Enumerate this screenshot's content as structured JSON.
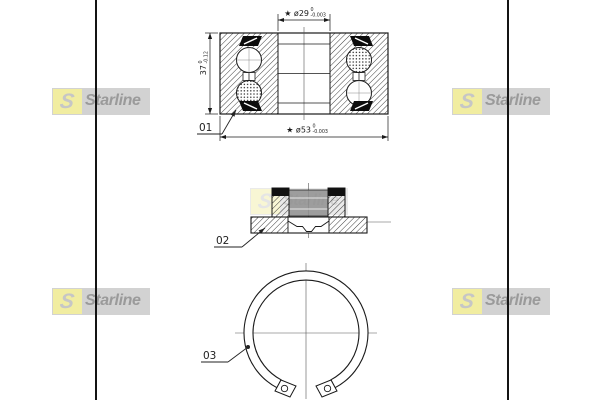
{
  "brand": {
    "name": "Starline",
    "logo_initial": "S"
  },
  "callouts": {
    "part1": "01",
    "part2": "02",
    "part3": "03"
  },
  "dimensions": {
    "bore": {
      "label": "★ ø29",
      "tol_upper": "0",
      "tol_lower": "-0.003"
    },
    "outer_diameter": {
      "label": "★ ø53",
      "tol_upper": "0",
      "tol_lower": "-0.003"
    },
    "width": {
      "label": "37",
      "tol_upper": "0",
      "tol_lower": "-0.12"
    }
  },
  "colors": {
    "logo_background": "#d2d2d2",
    "logo_yellow": "#f1eda1",
    "logo_text_gray": "#9a9a9a",
    "drawing_ink": "#1a1a1a",
    "table_border": "#141414"
  }
}
